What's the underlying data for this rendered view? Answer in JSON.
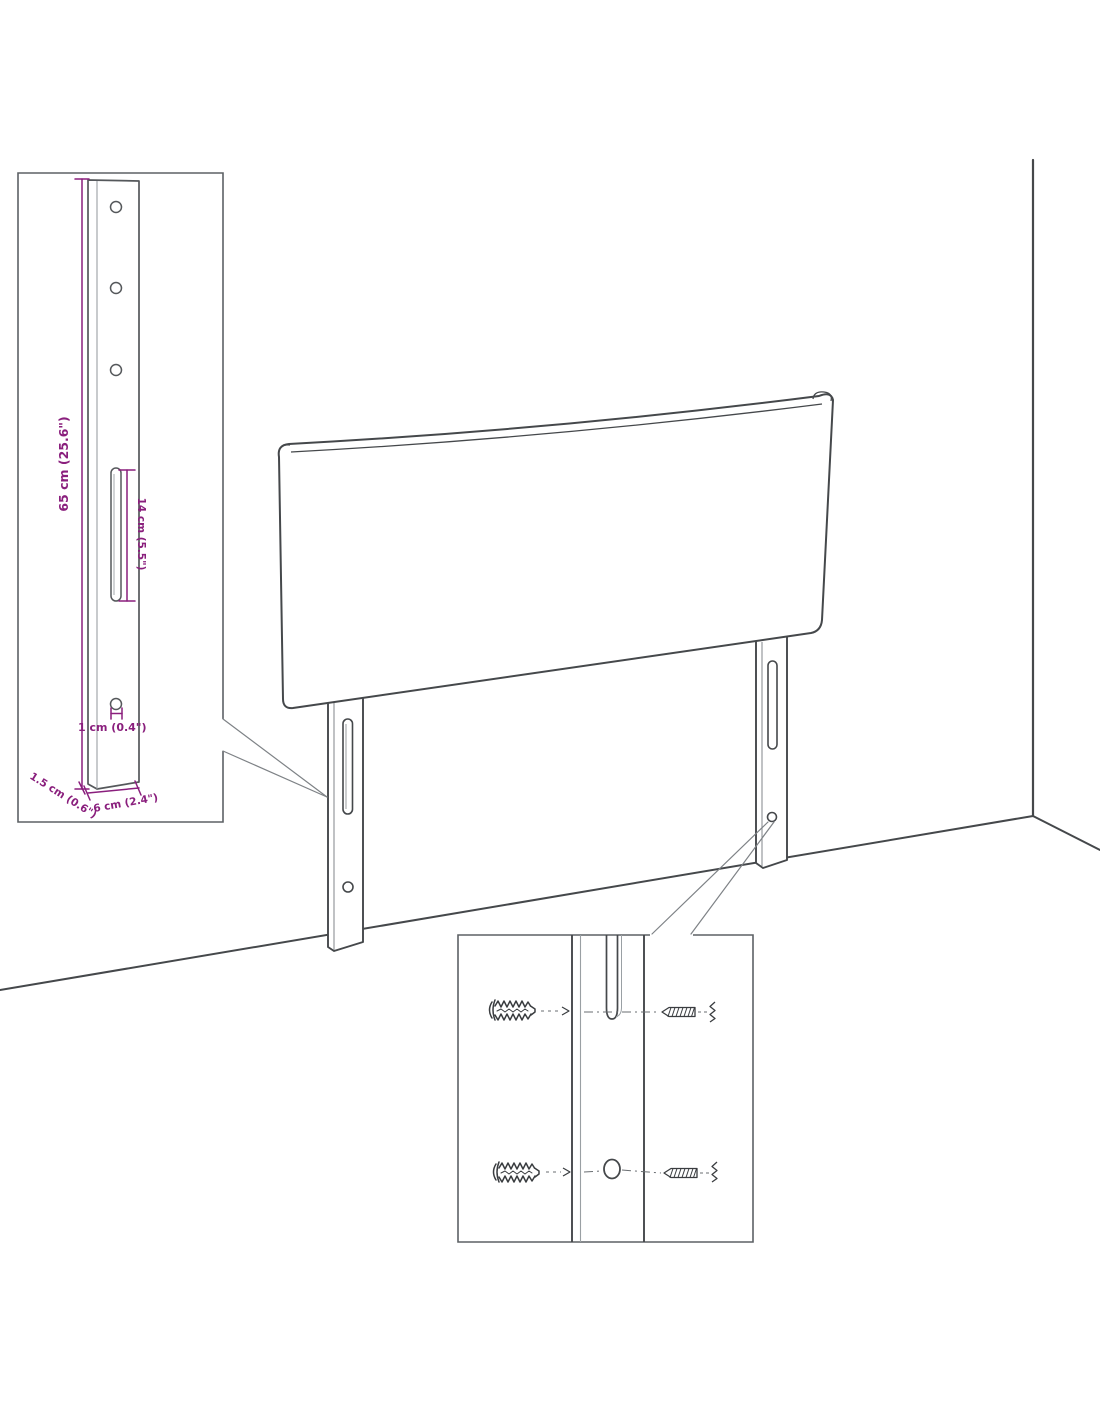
{
  "title": "Headboard wall-mounting dimension diagram",
  "colors": {
    "dimension": "#8a1f7d",
    "line_dark": "#45484b",
    "line_light": "#8d9195",
    "inset_border": "#5d6165",
    "background": "#ffffff"
  },
  "bracket_inset": {
    "dim_height": "65 cm (25.6\")",
    "dim_slot": "14 cm (5.5\")",
    "dim_hole": "1 cm (0.4\")",
    "dim_width": "6 cm (2.4\")",
    "dim_depth": "1.5 cm (0.6\")"
  },
  "mounting_inset": {
    "left_parts": [
      "wall-plug",
      "wall-plug"
    ],
    "right_parts": [
      "screw",
      "screw"
    ]
  },
  "scene": {
    "parts": [
      "headboard-panel",
      "left-leg",
      "right-leg",
      "wall-corner",
      "floor-line"
    ]
  }
}
